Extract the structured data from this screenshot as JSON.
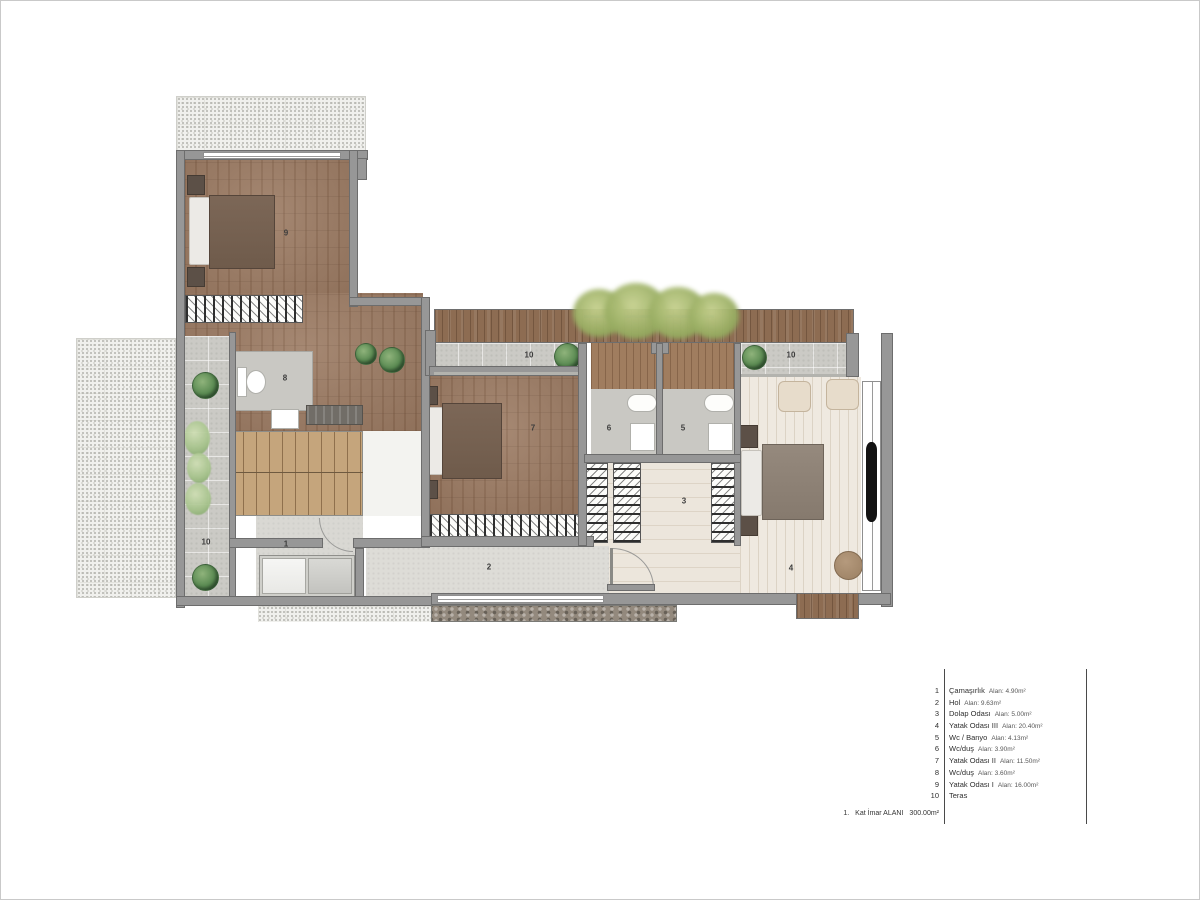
{
  "plan": {
    "labels": {
      "r1": "1",
      "r2": "2",
      "r3": "3",
      "r4": "4",
      "r5": "5",
      "r6": "6",
      "r7": "7",
      "r8": "8",
      "r9": "9",
      "t10_left": "10",
      "t10_mid": "10",
      "t10_right": "10"
    }
  },
  "legend": {
    "items": [
      {
        "num": "1",
        "name": "Çamaşırlık",
        "area": "Alan: 4.90m²"
      },
      {
        "num": "2",
        "name": "Hol",
        "area": "Alan: 9.63m²"
      },
      {
        "num": "3",
        "name": "Dolap Odası",
        "area": "Alan: 5.00m²"
      },
      {
        "num": "4",
        "name": "Yatak Odası III",
        "area": "Alan: 20.40m²"
      },
      {
        "num": "5",
        "name": "Wc / Banyo",
        "area": "Alan: 4.13m²"
      },
      {
        "num": "6",
        "name": "Wc/duş",
        "area": "Alan: 3.90m²"
      },
      {
        "num": "7",
        "name": "Yatak Odası II",
        "area": "Alan: 11.50m²"
      },
      {
        "num": "8",
        "name": "Wc/duş",
        "area": "Alan: 3.60m²"
      },
      {
        "num": "9",
        "name": "Yatak Odası I",
        "area": "Alan: 16.00m²"
      },
      {
        "num": "10",
        "name": "Teras",
        "area": ""
      }
    ]
  },
  "footer": {
    "num": "1.",
    "label": "Kat İmar ALANI",
    "value": "300.00m²"
  },
  "colors": {
    "wall": "#979797",
    "wood_dark": "#9b7a62",
    "wood_deck": "#8d6c52",
    "wood_stairs": "#c5a57c",
    "floor_cream": "#ece6dc",
    "paver_gray": "#cbcac5",
    "plant_green": "#5a8a52"
  }
}
